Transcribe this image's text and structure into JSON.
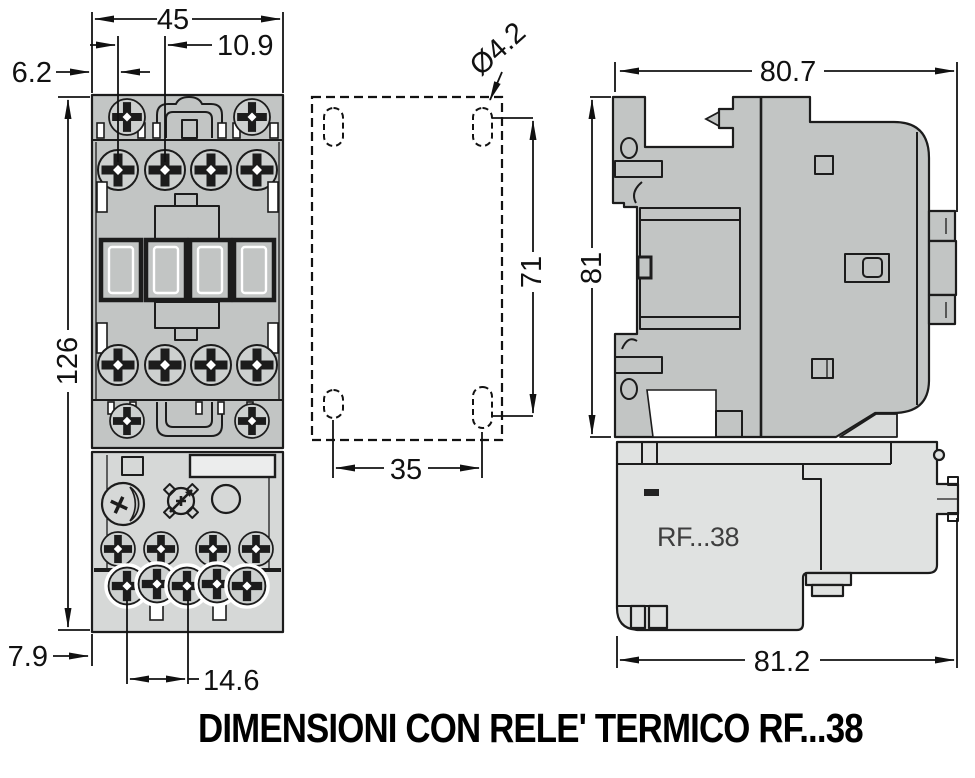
{
  "caption": "DIMENSIONI CON RELE' TERMICO RF...38",
  "colors": {
    "outline": "#1c1c1c",
    "contactor_gray": "#c2c5c4",
    "relay_front_gray": "#d6d8d7",
    "relay_side_gray": "#e0e2e1",
    "background": "#ffffff"
  },
  "front_view": {
    "dims": {
      "overall_width": "45",
      "screw_pitch": "10.9",
      "edge_to_screw": "6.2",
      "overall_height": "126",
      "foot_depth": "7.9",
      "terminal_pitch": "14.6"
    }
  },
  "drilling_plan": {
    "hole_diameter": "Ø4.2",
    "vertical_hole_pitch": "71",
    "horizontal_hole_pitch": "35"
  },
  "side_view": {
    "relay_label": "RF...38",
    "dims": {
      "depth_top": "80.7",
      "height": "81",
      "depth_bottom": "81.2"
    }
  }
}
